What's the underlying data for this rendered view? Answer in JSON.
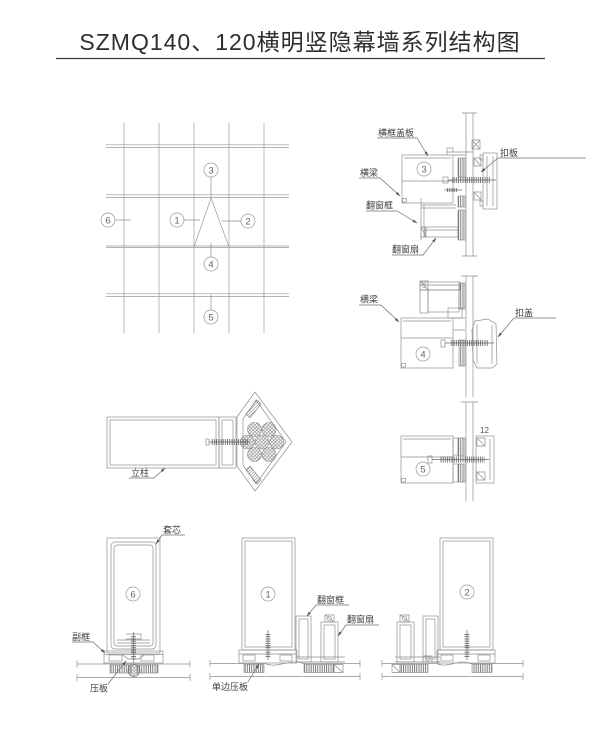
{
  "title": "SZMQ140、120横明竖隐幕墙系列结构图",
  "callouts": {
    "c1": "1",
    "c2": "2",
    "c3": "3",
    "c4": "4",
    "c5": "5",
    "c6": "6"
  },
  "labels": {
    "heng_kuang_gai_ban": "横框盖板",
    "kou_ban": "扣板",
    "heng_liang": "横梁",
    "fan_chuang_kuang": "翻窗框",
    "fan_chuang_shan": "翻窗扇",
    "kou_gai": "扣盖",
    "li_zhu": "立柱",
    "tao_xin": "套芯",
    "fu_kuang": "副框",
    "ya_ban": "压板",
    "dan_bian_ya_ban": "单边压板"
  },
  "dimensions": {
    "glass_thickness": "12"
  },
  "colors": {
    "line": "#8f8f8f",
    "accent_line": "#5f5f5f",
    "text": "#3d3d3d",
    "background": "#ffffff"
  }
}
